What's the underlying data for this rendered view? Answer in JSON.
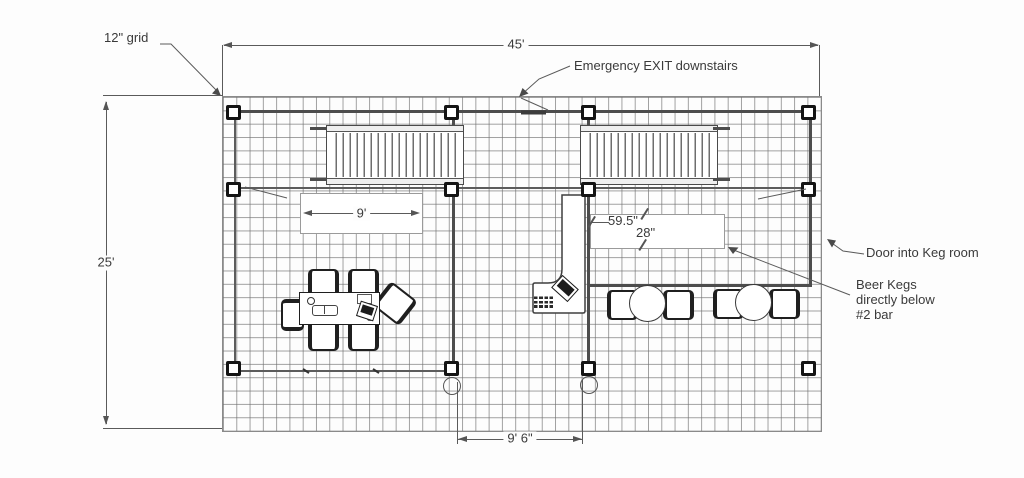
{
  "annotations": {
    "grid_note": "12\" grid",
    "emergency_exit": "Emergency EXIT downstairs",
    "door_keg_room": "Door into Keg room",
    "beer_kegs": [
      "Beer Kegs",
      "directly below",
      "#2 bar"
    ]
  },
  "dimensions": {
    "overall_width": "45'",
    "overall_depth": "25'",
    "stair_run": "9'",
    "bar_length": "59.5\"",
    "bar_depth": "28\"",
    "door_span": "9' 6\""
  },
  "colors": {
    "wall": "#4d4d4d",
    "grid_line": "#6e6e6e",
    "dimension": "#555555",
    "text": "#3a3a3a",
    "background": "#fdfdfd"
  }
}
